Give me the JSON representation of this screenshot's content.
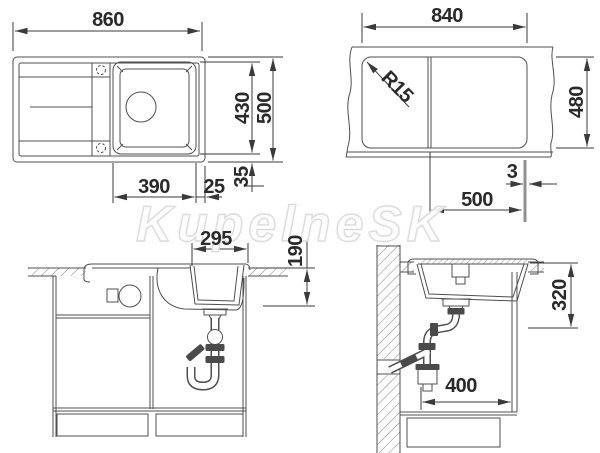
{
  "watermark": "KupelneSK",
  "views": {
    "top": {
      "dims": {
        "overall_width": "860",
        "overall_depth": "500",
        "bowl_depth": "430",
        "bowl_width": "390",
        "bowl_right_offset": "25",
        "rim_margin": "35"
      }
    },
    "cutout": {
      "dims": {
        "width": "840",
        "depth": "480",
        "corner_radius": "R15",
        "divider_thickness": "3",
        "bowl_section_width": "500"
      }
    },
    "front_section": {
      "dims": {
        "bowl_top_width": "295",
        "bowl_height": "190"
      }
    },
    "side_section": {
      "dims": {
        "under_counter_clearance": "320",
        "min_cabinet_width": "400"
      }
    }
  },
  "colors": {
    "drawing_line": "#4f4f4f",
    "dimension_line": "#3a3a3a",
    "divider_mark": "#8f8f8f"
  }
}
